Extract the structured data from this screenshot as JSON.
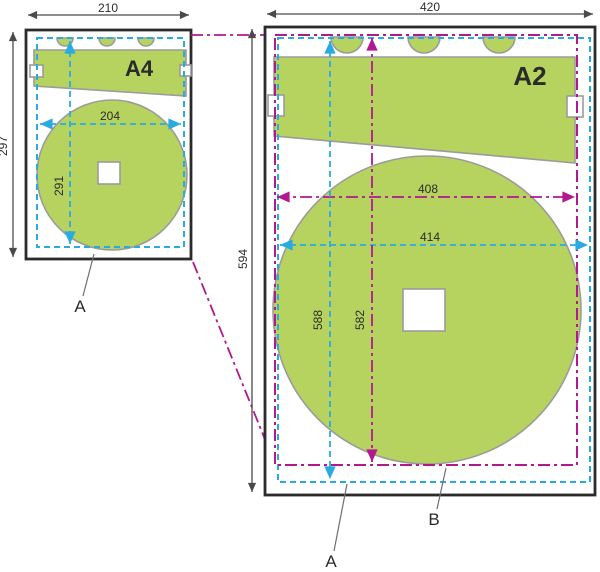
{
  "colors": {
    "page-border": "#2b2b2b",
    "content-fill": "#b7d35f",
    "content-stroke": "#9b9b9b",
    "print-area": "#29abe2",
    "scaled-area": "#b2188f",
    "dimension": "#4a4a4a",
    "text": "#2b2b2b"
  },
  "a4": {
    "label": "A4",
    "width": "210",
    "height": "297",
    "print_width": "204",
    "print_height": "291",
    "callout": "A"
  },
  "a2": {
    "label": "A2",
    "width": "420",
    "height": "594",
    "print_width": "414",
    "print_height": "588",
    "scaled_width": "408",
    "scaled_height": "582",
    "print_callout": "A",
    "scaled_callout": "B"
  }
}
